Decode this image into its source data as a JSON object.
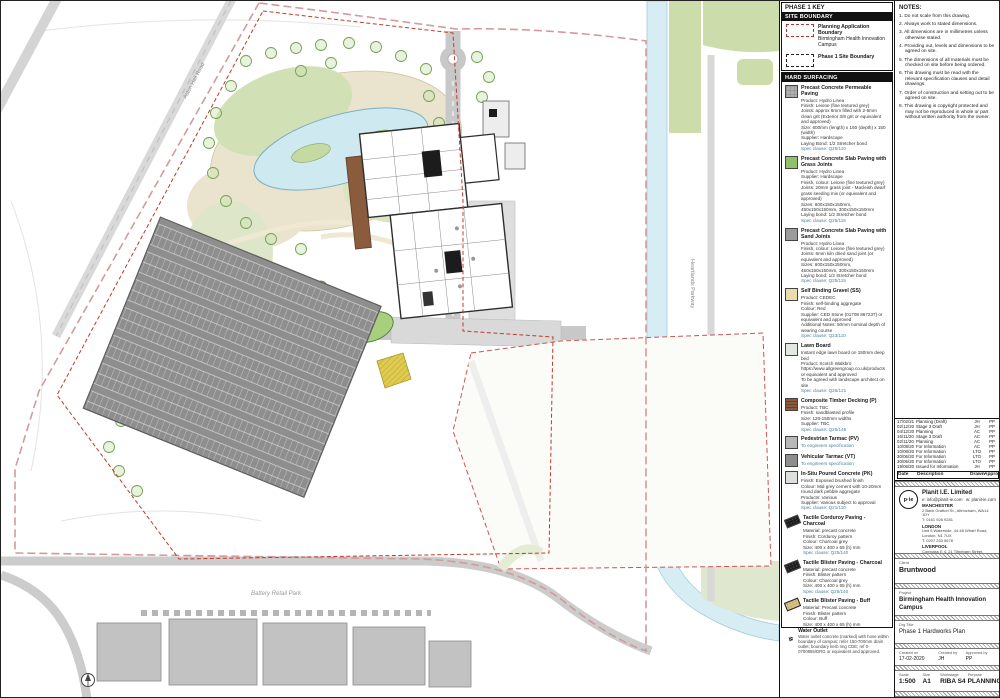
{
  "colors": {
    "boundary_pink": "#d49a9a",
    "boundary_red": "#c0392b",
    "road_grey": "#c8c8c8",
    "parking_grey": "#8e8e8e",
    "pond_blue": "#cfe9f1",
    "landscape_green": "#d2e0b5",
    "deck_brown": "#8a5b3c",
    "tactile_black": "#1e1e1e",
    "tactile_buff": "#d8c185"
  },
  "map": {
    "labels": {
      "aston": "Aston Hall Road",
      "parkway": "Heartlands Parkway",
      "retail": "Battery Retail Park"
    }
  },
  "key": {
    "title": "PHASE 1 KEY",
    "subtitle": "SITE BOUNDARY",
    "items": [
      {
        "label": "Planning Application Boundary",
        "sub": "Birmingham Health Innovation Campus"
      },
      {
        "label": "Phase 1 Site Boundary",
        "sub": ""
      }
    ]
  },
  "legend": {
    "title": "HARD SURFACING",
    "items": [
      {
        "name": "Precast Concrete Permeable Paving",
        "lines": [
          "Product: Hydro Linea",
          "Finish: Leione (fine textured grey)",
          "Joints: approx 6mm filled with 2-6mm clean grit (Exterior 3/8 grit or equivalent and approved)",
          "Size: 600mm (length) x 150 (depth) x 150 (width)",
          "Supplier: Hardscape",
          "Laying Bond: 1/2 Stretcher bond",
          "Spec clause: Q25/110"
        ]
      },
      {
        "name": "Precast Concrete Slab Paving with Grass Joints",
        "lines": [
          "Product: Hydro Linea",
          "Supplier: Hardscape",
          "Finish, colour: Leione (fine textured grey)",
          "Joints: 20mm grass joint - Macleish dwarf grass seeding mix (or equivalent and approved)",
          "Sizes: 600x150x150mm, 450x150x150mm, 300x150x150mm",
          "Laying bond: 1/2 Stretcher bond",
          "Spec clause: Q25/115"
        ]
      },
      {
        "name": "Precast Concrete Slab Paving with Sand Joints",
        "lines": [
          "Product: Hydro Linea",
          "Finish, colour: Leione (fine textured grey)",
          "Joints: 6mm kiln dried sand joint (or equivalent and approved)",
          "Sizes: 600x150x150mm, 450x150x150mm, 300x150x150mm",
          "Laying bond: 1/2 Stretcher bond",
          "Spec clause: Q25/115"
        ]
      },
      {
        "name": "Self Binding Gravel (SS)",
        "lines": [
          "Product: CEDEC",
          "Finish: self-binding aggregate",
          "Colour: Red",
          "Supplier: CED Stone (01708 867237) or equivalent and approved",
          "Additional Notes: 50mm nominal depth of wearing course",
          "Spec clause: Q23/110"
        ]
      },
      {
        "name": "Lawn Board",
        "lines": [
          "Instant edge lawn board on 150mm deep bed",
          "Product: Scotch Walkbro",
          "https://www.allgreengroup.co.uk/products or equivalent and approved",
          "To be agreed with landscape architect on site",
          "Spec clause: Q25/121"
        ]
      },
      {
        "name": "Composite Timber Decking (P)",
        "lines": [
          "Product: TBC",
          "Finish: sandblasted profile",
          "Size: 120-150mm widths",
          "Supplier: TBC",
          "Spec clause: Q25/145"
        ]
      },
      {
        "name": "Pedestrian Tarmac (PV)",
        "lines": [
          "To engineers specification"
        ]
      },
      {
        "name": "Vehicular Tarmac (VT)",
        "lines": [
          "To engineers specification"
        ]
      },
      {
        "name": "In-Situ Poured Concrete (PK)",
        "lines": [
          "Finish: Exposed brushed finish",
          "Colour: Mid grey cement with 10-20mm round dark pebble aggregate",
          "Products: Various",
          "Supplier: Various subject to approval",
          "Spec clause: Q21/110"
        ]
      },
      {
        "name": "Tactile Corduroy Paving - Charcoal",
        "lines": [
          "Material: precast concrete",
          "Finish: Corduroy pattern",
          "Colour: Charcoal grey",
          "Size: 400 x 400 x 65 (h) mm",
          "Spec clause: Q25/140"
        ]
      },
      {
        "name": "Tactile Blister Paving - Charcoal",
        "lines": [
          "Material: precast concrete",
          "Finish: Blister pattern",
          "Colour: Charcoal grey",
          "Size: 400 x 400 x 65 (h) mm",
          "Spec clause: Q25/140"
        ]
      },
      {
        "name": "Tactile Blister Paving - Buff",
        "lines": [
          "Material: Precast concrete",
          "Finish: Blister pattern",
          "Colour: Buff",
          "Size: 400 x 400 x 65 (h) mm",
          "Spec clause: Q25/140"
        ]
      }
    ]
  },
  "water_note": {
    "title": "Water Outlet",
    "text": "Water outlet concrete (marked) with hose within boundary of campus; refer 150-700mm drain outlet; boundary kerb ring CDE; ref 0-0700855/DRG or equivalent and approved."
  },
  "notes": {
    "title": "NOTES:",
    "items": [
      "1. Do not scale from this drawing.",
      "2. Always work to stated dimensions.",
      "3. All dimensions are in millimetres unless otherwise stated.",
      "4. Providing out, levels and dimensions to be agreed on site.",
      "5. The dimensions of all materials must be checked on site before being ordered.",
      "6. This drawing must be read with the relevant specification clauses and detail drawings.",
      "7. Order of construction and setting out to be agreed on site.",
      "8. This drawing is copyright protected and may not be reproduced in whole or part without written authority from the owner."
    ]
  },
  "revisions": {
    "headers": {
      "date": "Date",
      "description": "Description",
      "drawn": "Drawn",
      "approved": "Approved"
    },
    "rows": [
      {
        "date": "01/03/21",
        "description": "Planning",
        "drawn": "JH",
        "approved": "PP"
      },
      {
        "date": "17/02/21",
        "description": "Planning (Draft)",
        "drawn": "JH",
        "approved": "PP"
      },
      {
        "date": "02/12/20",
        "description": "Stage 3 Draft",
        "drawn": "JH",
        "approved": "PP"
      },
      {
        "date": "04/12/20",
        "description": "Planning",
        "drawn": "AC",
        "approved": "PP"
      },
      {
        "date": "16/11/20",
        "description": "Stage 3 Draft",
        "drawn": "AC",
        "approved": "PP"
      },
      {
        "date": "02/11/20",
        "description": "Planning",
        "drawn": "AC",
        "approved": "PP"
      },
      {
        "date": "10/08/20",
        "description": "For Information",
        "drawn": "AC",
        "approved": "PP"
      },
      {
        "date": "10/08/20",
        "description": "For Information",
        "drawn": "LTO",
        "approved": "PP"
      },
      {
        "date": "30/06/20",
        "description": "For Information",
        "drawn": "LTO",
        "approved": "PP"
      },
      {
        "date": "30/06/20",
        "description": "For Information",
        "drawn": "LTO",
        "approved": "PP"
      },
      {
        "date": "19/06/20",
        "description": "Issued for Information",
        "drawn": "JH",
        "approved": "PP"
      }
    ]
  },
  "firm": {
    "name": "Planit I.E. Limited",
    "logo": "p·ie",
    "email": "e: info@planit-ie.com",
    "web": "w: planit-ie.com",
    "offices": [
      {
        "city": "MANCHESTER",
        "address": "2 Back Grafton St., Altrincham, WA14 1DY",
        "phone": "T: 0161 928 9281"
      },
      {
        "city": "LONDON",
        "address": "Unit 5 Waterside, 44-48 Wharf Road, London, N1 7UX",
        "phone": "T: 0207 253 5678"
      },
      {
        "city": "LIVERPOOL",
        "address": "Compass E 4, 21 Tithebarn Street, Liverpool, L2 2BP",
        "phone": "T: 0151 368 1156"
      }
    ]
  },
  "titleblock": {
    "client_label": "Client",
    "client": "Bruntwood",
    "project_label": "Project",
    "project": "Birmingham Health Innovation Campus",
    "title_label": "Drg Title",
    "title": "Phase 1 Hardworks Plan",
    "created_on_label": "Created on",
    "created_on": "17-02-2020",
    "created_by_label": "Created by",
    "created_by": "JH",
    "approved_by_label": "Approved by",
    "approved_by": "PP",
    "scale_label": "Scale",
    "scale": "1:500",
    "size_label": "Size",
    "size": "A1",
    "workstage_label": "Workstage",
    "workstage": "RIBA S4",
    "purpose_label": "Purpose",
    "purpose": "PLANNING",
    "drg_no_label": "Drg No.",
    "drg_no": "2272-PLA-XX-XX-DR-L-1001",
    "suitability_label": "Suitability",
    "suitability": "S2",
    "revision_label": "Revision",
    "revision": "P18"
  }
}
